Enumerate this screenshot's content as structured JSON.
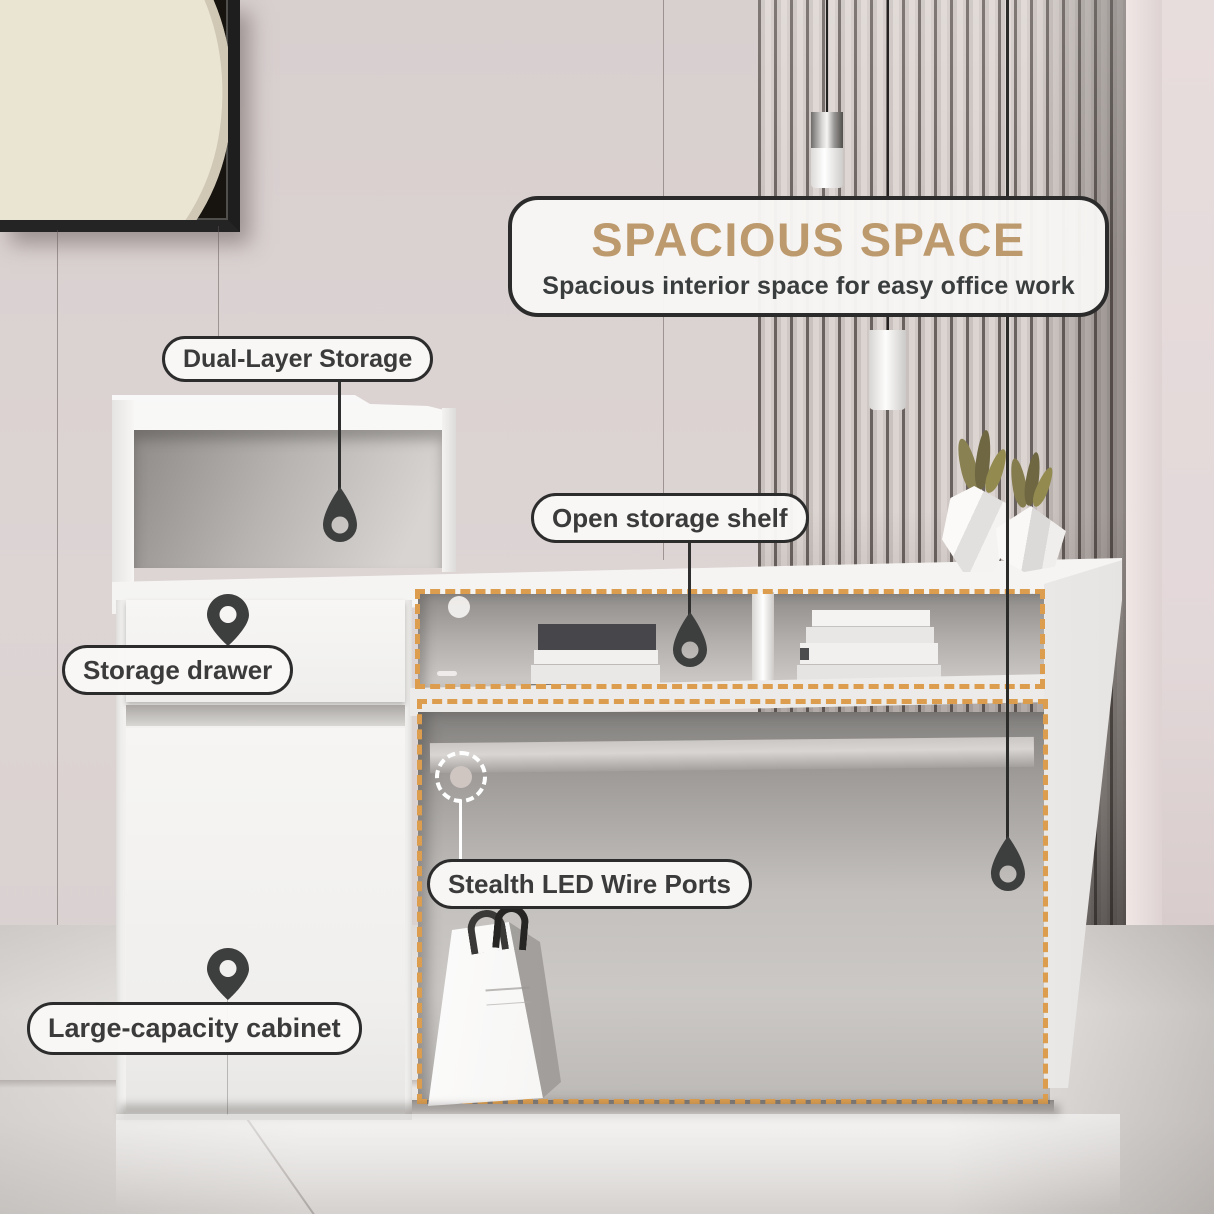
{
  "banner": {
    "title": "SPACIOUS SPACE",
    "subtitle": "Spacious interior space for easy office work"
  },
  "callouts": {
    "dual_layer": {
      "label": "Dual-Layer Storage"
    },
    "open_shelf": {
      "label": "Open storage shelf"
    },
    "storage_drawer": {
      "label": "Storage drawer"
    },
    "led_ports": {
      "label": "Stealth LED Wire Ports"
    },
    "cabinet": {
      "label": "Large-capacity cabinet"
    }
  },
  "icons": {
    "storage_drawer_pin": "location-pin",
    "cabinet_pin": "location-pin",
    "dual_layer_pin": "teardrop-pin",
    "open_shelf_pin": "teardrop-pin",
    "desk_side_pin": "teardrop-pin",
    "led_port_marker": "dashed-circle-port"
  },
  "colors": {
    "accent_gold_title": "#bd9a6e",
    "dashed_outline": "#dc9e4e",
    "pin": "#3d3e3e",
    "label_text": "#3b3b3b",
    "label_border": "#2c2c2c",
    "label_bg": "#f8f7f5"
  }
}
